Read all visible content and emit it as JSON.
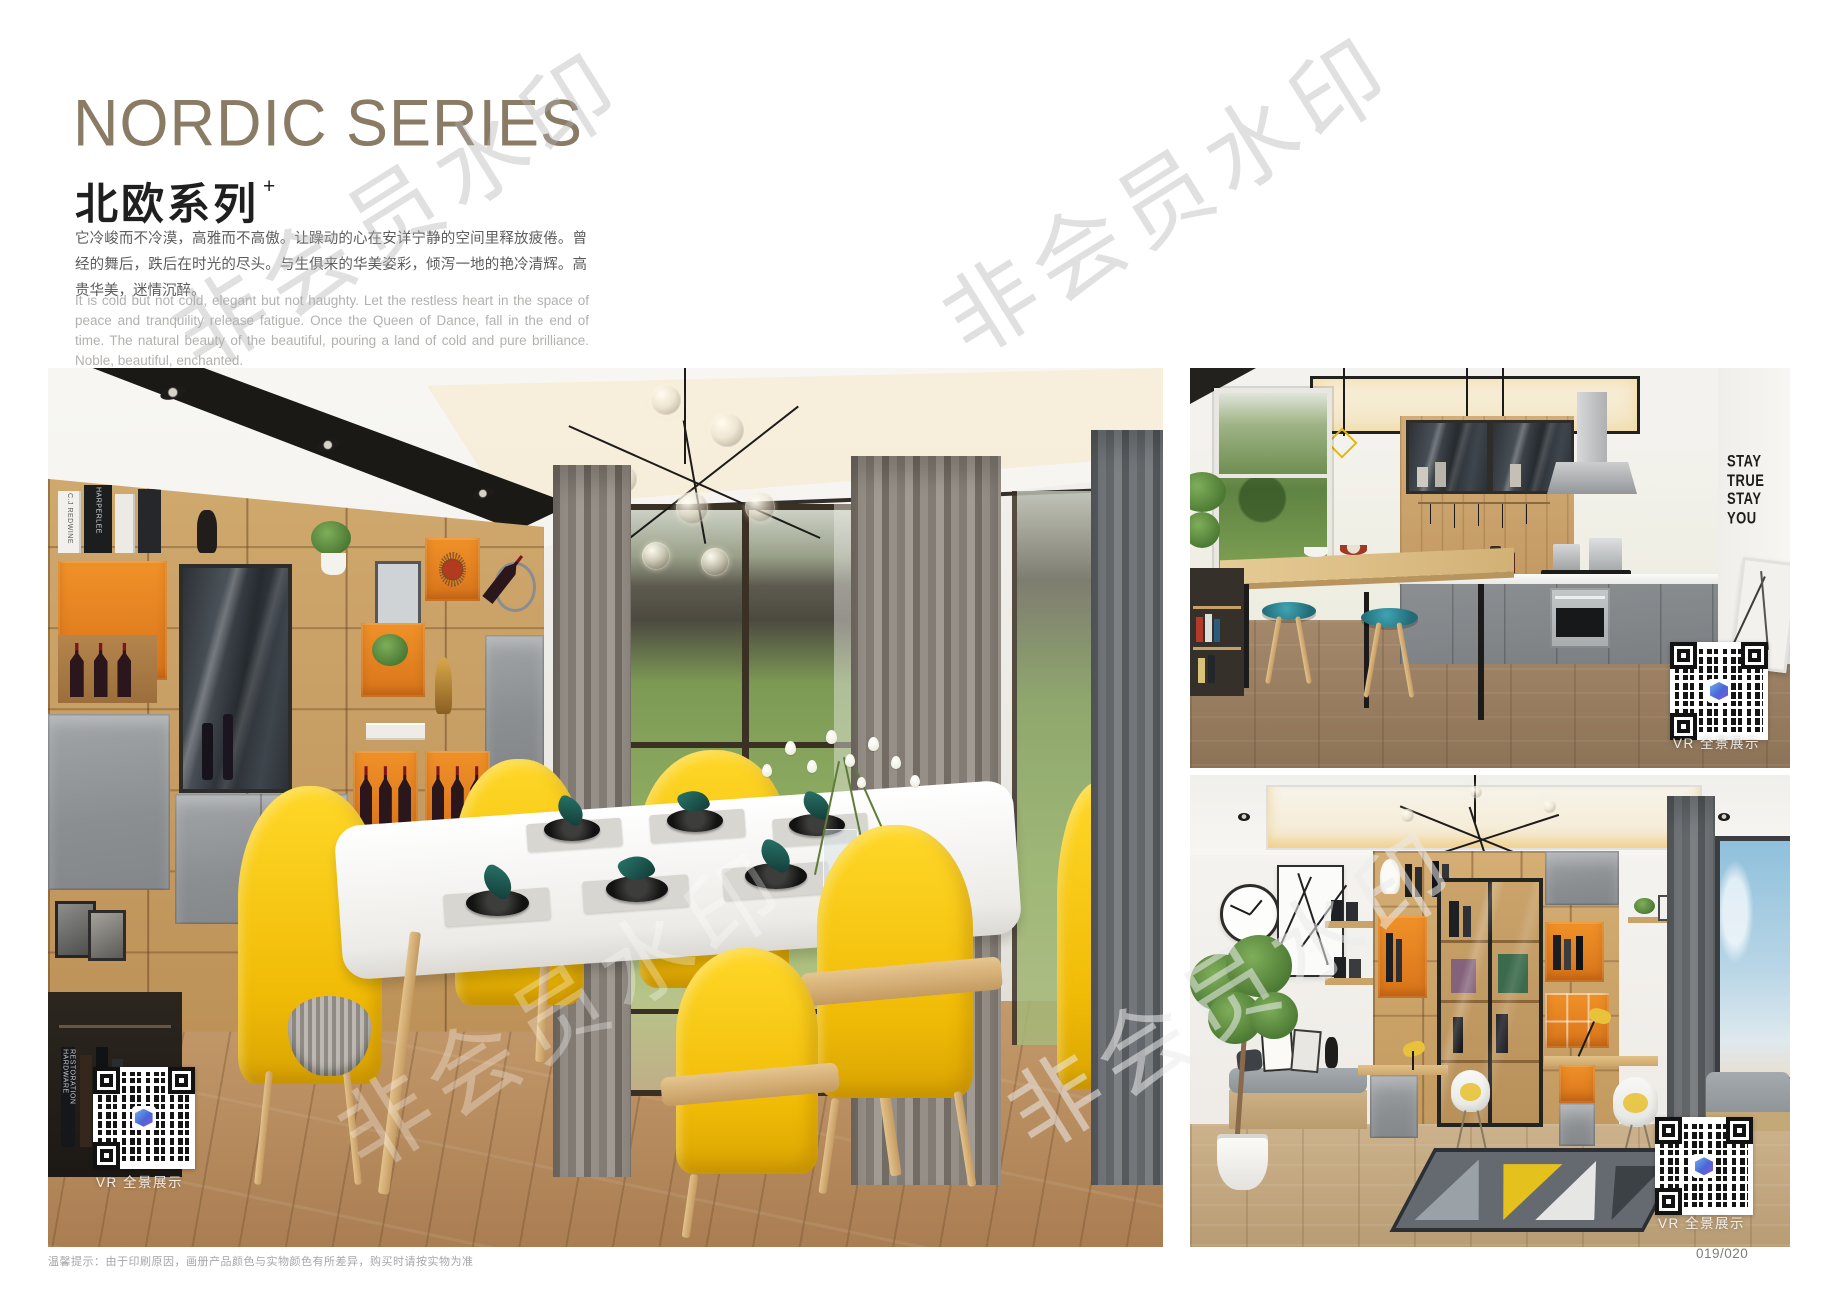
{
  "header": {
    "title_en": "NORDIC SERIES",
    "title_cn": "北欧系列",
    "title_superscript": "+",
    "paragraph_cn": "它冷峻而不冷漠，高雅而不高傲。让躁动的心在安详宁静的空间里释放疲倦。曾经的舞后，跌后在时光的尽头。与生俱来的华美姿彩，倾泻一地的艳冷清辉。高贵华美，迷情沉醉。",
    "paragraph_en": "It is cold but not cold, elegant but not haughty. Let the restless heart in the space of peace and tranquility release fatigue. Once the Queen of Dance, fall in the end of time. The natural beauty of the beautiful, pouring a land of cold and pure brilliance. Noble, beautiful, enchanted."
  },
  "watermark": {
    "text": "非会员水印"
  },
  "photos": {
    "dining": {
      "label": "Nordic dining room with yellow chairs and wall shelving",
      "vr_label": "VR 全景展示",
      "book_spines": [
        "HARPERLEE",
        "C.J REDWINE",
        "RESTORATION HARDWARE"
      ]
    },
    "kitchen": {
      "label": "Nordic kitchen with breakfast bar",
      "vr_label": "VR 全景展示",
      "wall_quote": [
        "STAY",
        "TRUE",
        "STAY",
        "YOU"
      ]
    },
    "study": {
      "label": "Nordic study with double desks and display cabinet",
      "vr_label": "VR 全景展示"
    }
  },
  "footer": {
    "note": "温馨提示：由于印刷原因，画册产品颜色与实物颜色有所差异，购买时请按实物为准",
    "page_number": "019/020"
  },
  "colors": {
    "title": "#8A7B64",
    "accent_orange": "#E8851F",
    "accent_yellow": "#F2BE0A",
    "accent_teal": "#1E5C57",
    "wood": "#C9A36B",
    "cabinet_gray": "#8F9295"
  }
}
